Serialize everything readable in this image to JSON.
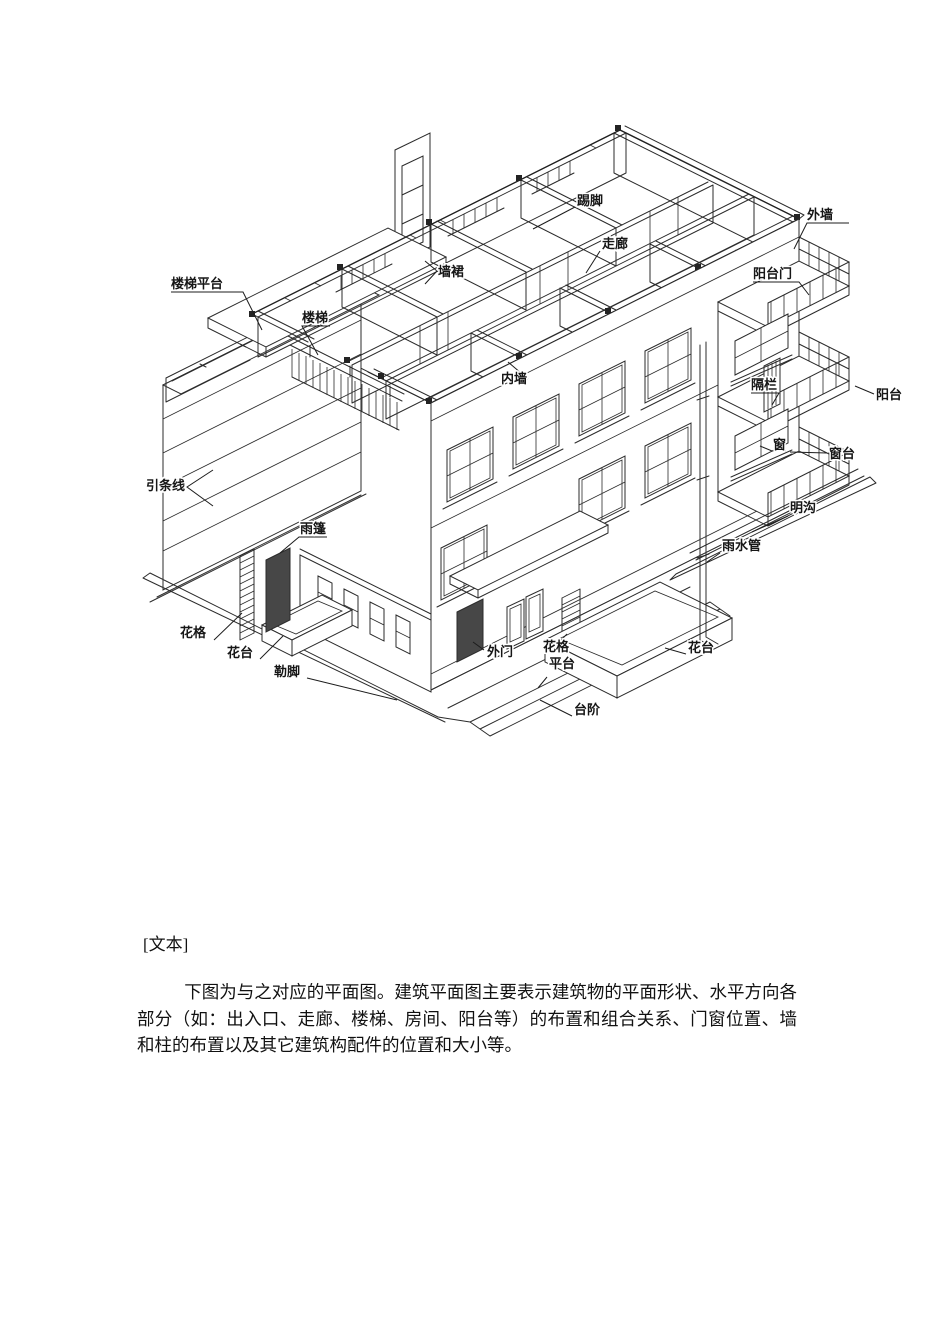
{
  "document": {
    "section_tag": "[文本]",
    "paragraph": "下图为与之对应的平面图。建筑平面图主要表示建筑物的平面形状、水平方向各部分（如：出入口、走廊、楼梯、房间、阳台等）的布置和组合关系、门窗位置、墙和柱的布置以及其它建筑构配件的位置和大小等。"
  },
  "colors": {
    "ink": "#2b2b2b",
    "paper": "#ffffff"
  },
  "figure": {
    "kind": "building-axonometric-diagram",
    "labels": [
      {
        "t": "楼梯平台",
        "x": 171,
        "y": 288,
        "lead": [
          [
            171,
            292
          ],
          [
            243,
            292
          ],
          [
            262,
            330
          ]
        ]
      },
      {
        "t": "楼梯",
        "x": 302,
        "y": 322,
        "lead": [
          [
            330,
            326
          ],
          [
            302,
            326
          ],
          [
            318,
            355
          ]
        ]
      },
      {
        "t": "墙裙",
        "x": 438,
        "y": 276,
        "lead": [
          [
            425,
            261
          ],
          [
            437,
            271
          ],
          [
            425,
            284
          ]
        ]
      },
      {
        "t": "踢脚",
        "x": 577,
        "y": 205,
        "lead": [
          [
            575,
            207
          ],
          [
            533,
            229
          ]
        ]
      },
      {
        "t": "走廊",
        "x": 602,
        "y": 248,
        "lead": [
          [
            600,
            251
          ],
          [
            586,
            273
          ]
        ]
      },
      {
        "t": "外墙",
        "x": 807,
        "y": 219,
        "lead": [
          [
            849,
            223
          ],
          [
            807,
            223
          ],
          [
            794,
            249
          ]
        ]
      },
      {
        "t": "阳台门",
        "x": 753,
        "y": 278,
        "lead": [
          [
            753,
            282
          ],
          [
            799,
            282
          ],
          [
            809,
            295
          ]
        ]
      },
      {
        "t": "内墙",
        "x": 501,
        "y": 383,
        "lead": [
          [
            528,
            379
          ],
          [
            508,
            362
          ]
        ]
      },
      {
        "t": "隔栏",
        "x": 751,
        "y": 389,
        "lead": [
          [
            751,
            393
          ],
          [
            779,
            393
          ],
          [
            772,
            405
          ]
        ]
      },
      {
        "t": "阳台",
        "x": 876,
        "y": 399,
        "lead": [
          [
            874,
            394
          ],
          [
            855,
            386
          ]
        ]
      },
      {
        "t": "窗",
        "x": 773,
        "y": 449,
        "lead": [
          [
            786,
            451
          ],
          [
            772,
            451
          ],
          [
            760,
            446
          ]
        ]
      },
      {
        "t": "窗台",
        "x": 829,
        "y": 458,
        "lead": [
          [
            827,
            453
          ],
          [
            790,
            452
          ]
        ]
      },
      {
        "t": "引条线",
        "x": 146,
        "y": 490,
        "lead": [
          [
            213,
            470
          ],
          [
            187,
            487
          ],
          [
            213,
            506
          ]
        ]
      },
      {
        "t": "雨篷",
        "x": 300,
        "y": 533,
        "lead": [
          [
            327,
            537
          ],
          [
            299,
            537
          ],
          [
            280,
            553
          ]
        ]
      },
      {
        "t": "明沟",
        "x": 790,
        "y": 512,
        "lead": [
          [
            788,
            516
          ],
          [
            752,
            532
          ]
        ]
      },
      {
        "t": "雨水管",
        "x": 722,
        "y": 550,
        "lead": [
          [
            720,
            553
          ],
          [
            707,
            562
          ]
        ]
      },
      {
        "t": "花格",
        "x": 180,
        "y": 637,
        "lead": [
          [
            214,
            640
          ],
          [
            242,
            613
          ]
        ]
      },
      {
        "t": "花台",
        "x": 227,
        "y": 657,
        "lead": [
          [
            260,
            659
          ],
          [
            283,
            636
          ]
        ]
      },
      {
        "t": "勒脚",
        "x": 274,
        "y": 676,
        "lead": [
          [
            307,
            678
          ],
          [
            397,
            700
          ]
        ]
      },
      {
        "t": "外门",
        "x": 487,
        "y": 656,
        "lead": [
          [
            484,
            650
          ],
          [
            473,
            642
          ]
        ]
      },
      {
        "t": "花格",
        "x": 543,
        "y": 651,
        "lead": [
          [
            556,
            645
          ],
          [
            567,
            634
          ]
        ]
      },
      {
        "t": "花台",
        "x": 688,
        "y": 652,
        "lead": [
          [
            686,
            654
          ],
          [
            665,
            648
          ]
        ]
      },
      {
        "t": "平台",
        "x": 549,
        "y": 668,
        "lead": [
          [
            547,
            677
          ],
          [
            538,
            688
          ]
        ]
      },
      {
        "t": "台阶",
        "x": 574,
        "y": 714,
        "lead": [
          [
            572,
            716
          ],
          [
            540,
            700
          ]
        ]
      }
    ]
  }
}
